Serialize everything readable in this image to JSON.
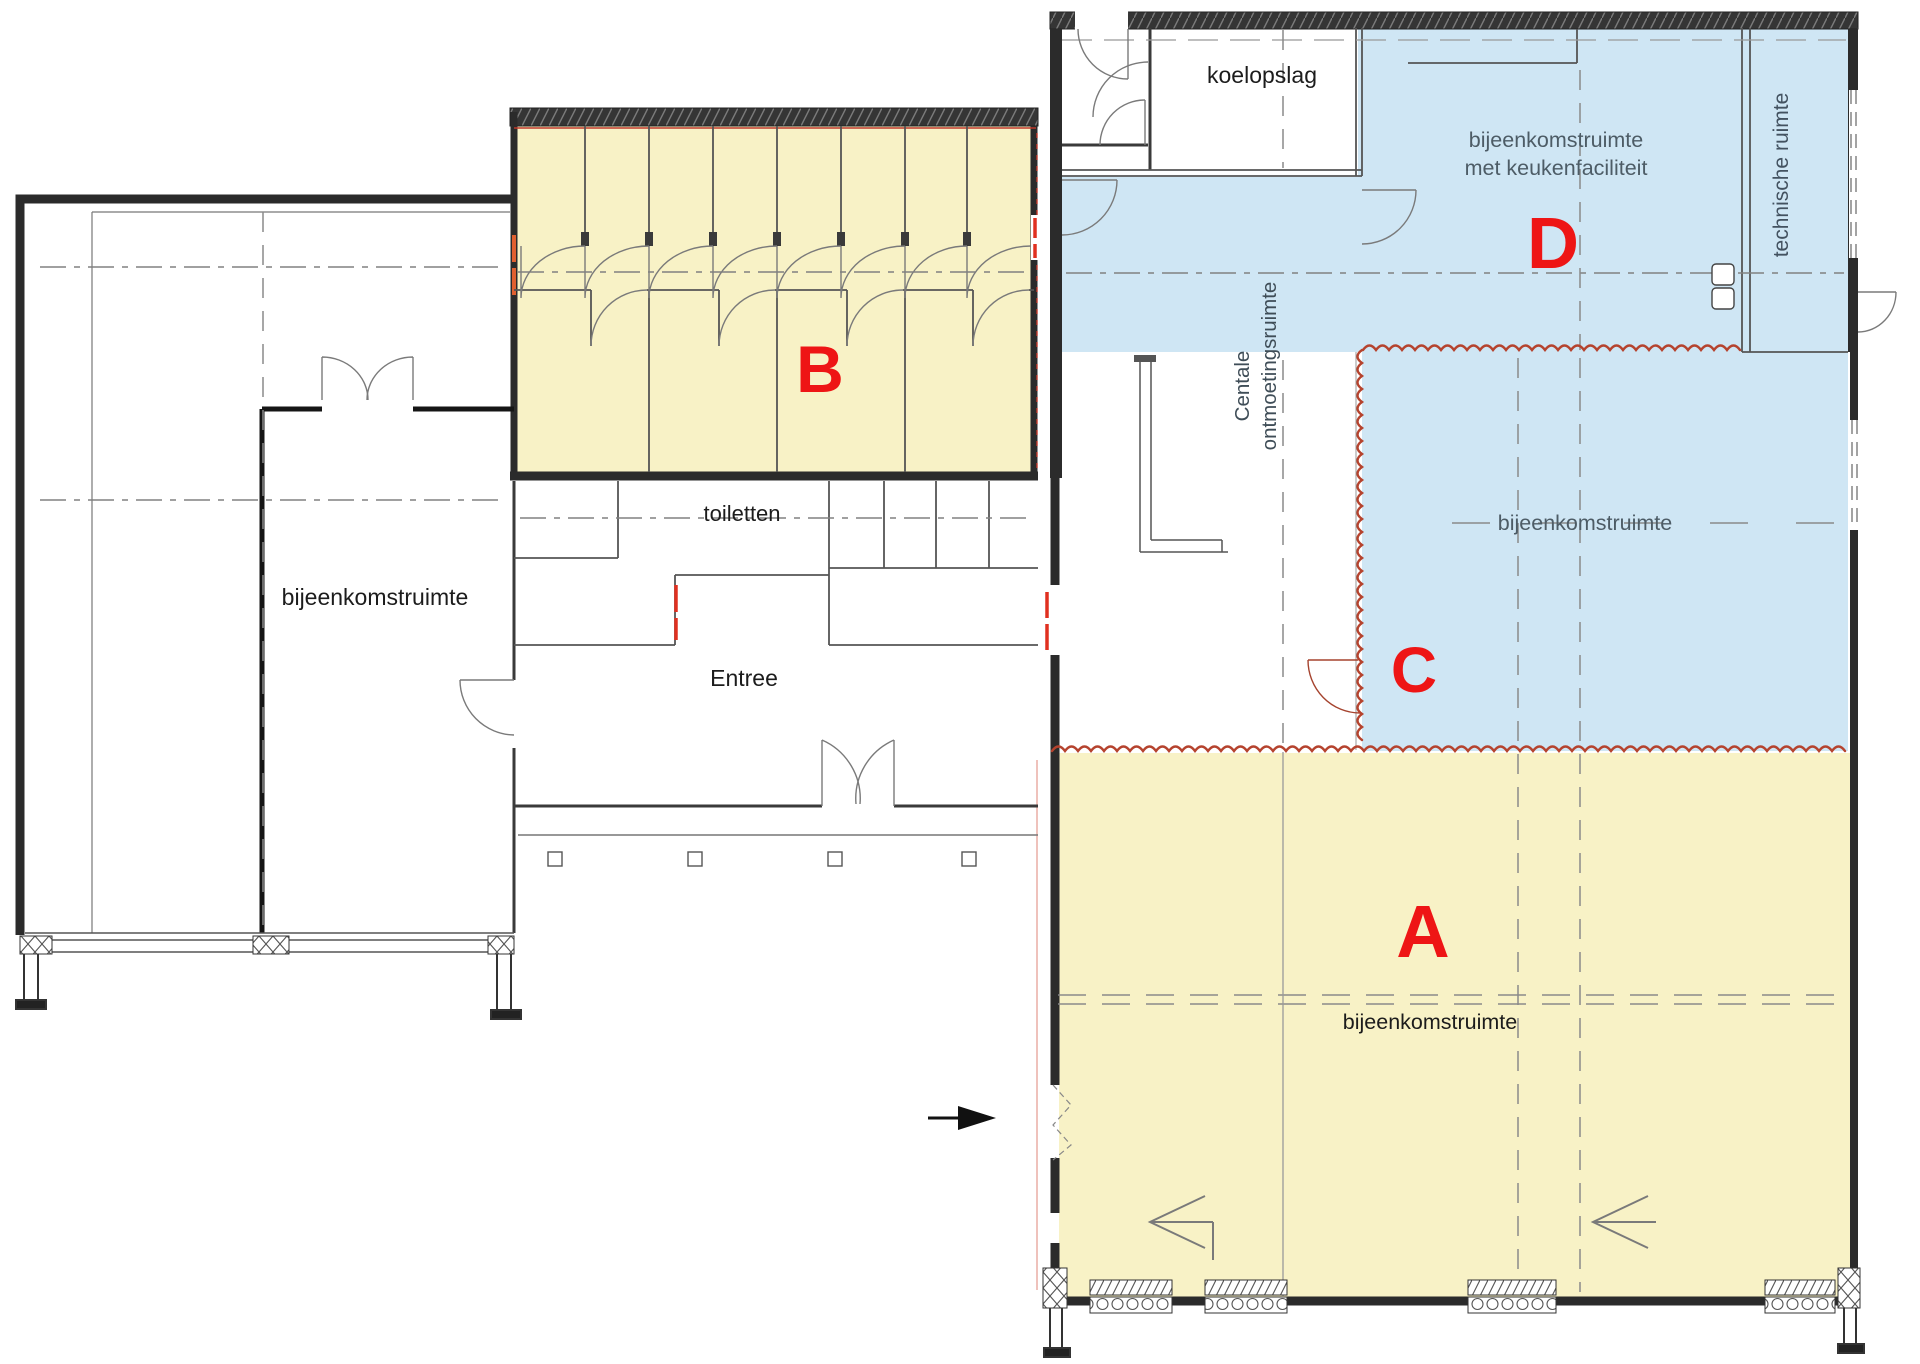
{
  "zones": {
    "a": {
      "letter": "A",
      "room_label": "bijeenkomstruimte"
    },
    "b": {
      "letter": "B"
    },
    "c": {
      "letter": "C",
      "room_label": "bijeenkomstruimte"
    },
    "d": {
      "letter": "D",
      "room_label_line1": "bijeenkomstruimte",
      "room_label_line2": "met keukenfaciliteit"
    }
  },
  "rooms": {
    "cold_storage": "koelopslag",
    "technical_room": "technische ruimte",
    "central_meeting_line1": "Centale",
    "central_meeting_line2": "ontmoetingsruimte",
    "toilets": "toiletten",
    "entrance": "Entree",
    "left_meeting_room": "bijeenkomstruimte"
  },
  "colors": {
    "zone_yellow": "#f8f2c6",
    "zone_blue": "#cfe6f4",
    "marker_red": "#ee1515",
    "boundary_red": "#b5432e",
    "door_mark_red": "#e03020",
    "wall_dark": "#2b2b2b"
  }
}
